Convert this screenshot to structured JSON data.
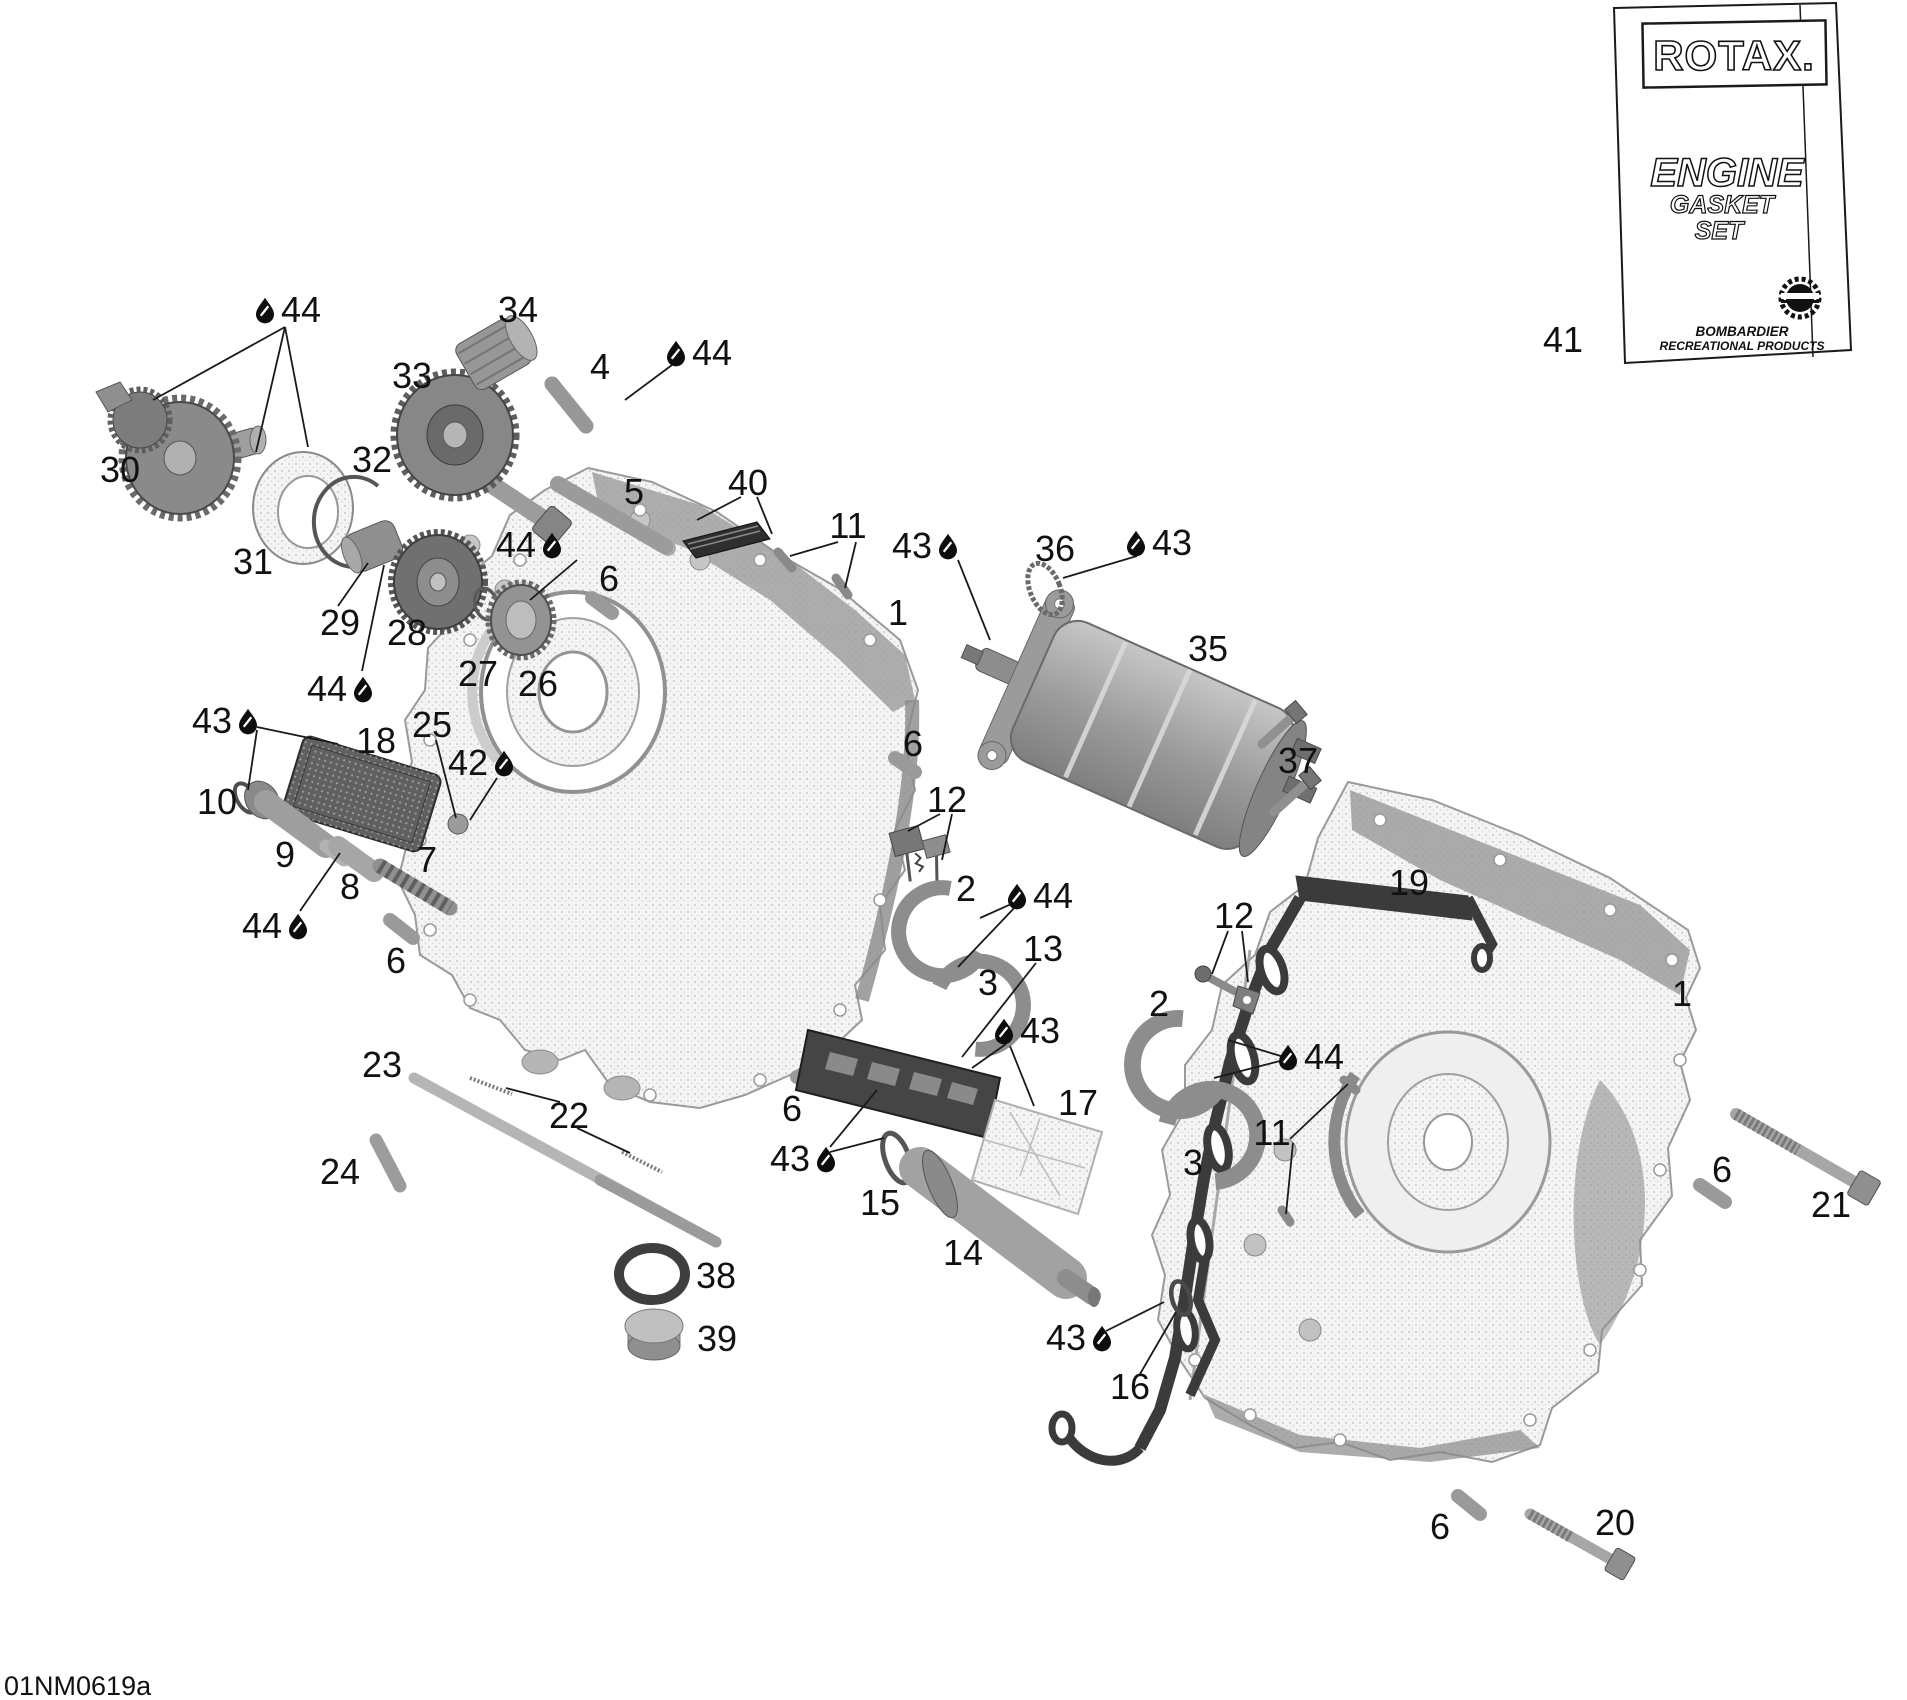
{
  "page": {
    "background": "#ffffff",
    "diagram_code": "01NM0619a"
  },
  "colors": {
    "ink": "#1a1a1a",
    "part_gray": "#9a9a9a",
    "dark_plate": "#454545",
    "gasket_dark": "#3b3b3b",
    "stipple_light": "#c9c9c9",
    "oil_drop": "#0d0d0d"
  },
  "gasket_kit": {
    "callout": "41",
    "brand": "ROTAX.",
    "product_line1": "ENGINE",
    "product_line2": "GASKET",
    "product_line3": "SET",
    "manufacturer_line1": "BOMBARDIER",
    "manufacturer_line2": "RECREATIONAL PRODUCTS",
    "logo": "gear-emblem-icon"
  },
  "legend": {
    "oil_drop_icon": "oil-drop-icon"
  },
  "callouts": [
    {
      "label": "44",
      "x": 301,
      "y": 309,
      "drop": "left"
    },
    {
      "label": "34",
      "x": 518,
      "y": 309,
      "drop": "none"
    },
    {
      "label": "4",
      "x": 600,
      "y": 366,
      "drop": "none"
    },
    {
      "label": "44",
      "x": 712,
      "y": 352,
      "drop": "left"
    },
    {
      "label": "33",
      "x": 412,
      "y": 375,
      "drop": "none"
    },
    {
      "label": "30",
      "x": 120,
      "y": 469,
      "drop": "none"
    },
    {
      "label": "32",
      "x": 372,
      "y": 459,
      "drop": "none"
    },
    {
      "label": "31",
      "x": 253,
      "y": 561,
      "drop": "none"
    },
    {
      "label": "5",
      "x": 634,
      "y": 491,
      "drop": "none"
    },
    {
      "label": "40",
      "x": 748,
      "y": 482,
      "drop": "none"
    },
    {
      "label": "44",
      "x": 516,
      "y": 544,
      "drop": "right"
    },
    {
      "label": "6",
      "x": 609,
      "y": 578,
      "drop": "none"
    },
    {
      "label": "11",
      "x": 848,
      "y": 525,
      "drop": "none"
    },
    {
      "label": "43",
      "x": 912,
      "y": 545,
      "drop": "right"
    },
    {
      "label": "36",
      "x": 1055,
      "y": 548,
      "drop": "none"
    },
    {
      "label": "43",
      "x": 1172,
      "y": 542,
      "drop": "left"
    },
    {
      "label": "1",
      "x": 898,
      "y": 612,
      "drop": "none"
    },
    {
      "label": "35",
      "x": 1208,
      "y": 648,
      "drop": "none"
    },
    {
      "label": "29",
      "x": 340,
      "y": 622,
      "drop": "none"
    },
    {
      "label": "28",
      "x": 407,
      "y": 632,
      "drop": "none"
    },
    {
      "label": "27",
      "x": 478,
      "y": 673,
      "drop": "none"
    },
    {
      "label": "26",
      "x": 538,
      "y": 683,
      "drop": "none"
    },
    {
      "label": "44",
      "x": 327,
      "y": 688,
      "drop": "right"
    },
    {
      "label": "43",
      "x": 212,
      "y": 720,
      "drop": "right"
    },
    {
      "label": "18",
      "x": 376,
      "y": 740,
      "drop": "none"
    },
    {
      "label": "25",
      "x": 432,
      "y": 724,
      "drop": "none"
    },
    {
      "label": "42",
      "x": 468,
      "y": 762,
      "drop": "right"
    },
    {
      "label": "10",
      "x": 217,
      "y": 801,
      "drop": "none"
    },
    {
      "label": "9",
      "x": 285,
      "y": 854,
      "drop": "none"
    },
    {
      "label": "8",
      "x": 350,
      "y": 886,
      "drop": "none"
    },
    {
      "label": "7",
      "x": 427,
      "y": 859,
      "drop": "none"
    },
    {
      "label": "44",
      "x": 262,
      "y": 925,
      "drop": "right"
    },
    {
      "label": "6",
      "x": 396,
      "y": 960,
      "drop": "none"
    },
    {
      "label": "12",
      "x": 947,
      "y": 799,
      "drop": "none"
    },
    {
      "label": "6",
      "x": 913,
      "y": 743,
      "drop": "none"
    },
    {
      "label": "2",
      "x": 966,
      "y": 888,
      "drop": "none"
    },
    {
      "label": "44",
      "x": 1053,
      "y": 895,
      "drop": "left"
    },
    {
      "label": "13",
      "x": 1043,
      "y": 948,
      "drop": "none"
    },
    {
      "label": "3",
      "x": 988,
      "y": 982,
      "drop": "none"
    },
    {
      "label": "43",
      "x": 1040,
      "y": 1030,
      "drop": "left"
    },
    {
      "label": "17",
      "x": 1078,
      "y": 1102,
      "drop": "none"
    },
    {
      "label": "2",
      "x": 1159,
      "y": 1003,
      "drop": "none"
    },
    {
      "label": "12",
      "x": 1234,
      "y": 915,
      "drop": "none"
    },
    {
      "label": "19",
      "x": 1409,
      "y": 882,
      "drop": "none"
    },
    {
      "label": "44",
      "x": 1324,
      "y": 1056,
      "drop": "left"
    },
    {
      "label": "11",
      "x": 1272,
      "y": 1132,
      "drop": "none"
    },
    {
      "label": "3",
      "x": 1193,
      "y": 1162,
      "drop": "none"
    },
    {
      "label": "37",
      "x": 1298,
      "y": 760,
      "drop": "none"
    },
    {
      "label": "1",
      "x": 1682,
      "y": 993,
      "drop": "none"
    },
    {
      "label": "6",
      "x": 1722,
      "y": 1169,
      "drop": "none"
    },
    {
      "label": "21",
      "x": 1831,
      "y": 1204,
      "drop": "none"
    },
    {
      "label": "23",
      "x": 382,
      "y": 1064,
      "drop": "none"
    },
    {
      "label": "22",
      "x": 569,
      "y": 1115,
      "drop": "none"
    },
    {
      "label": "24",
      "x": 340,
      "y": 1171,
      "drop": "none"
    },
    {
      "label": "38",
      "x": 716,
      "y": 1275,
      "drop": "none"
    },
    {
      "label": "39",
      "x": 717,
      "y": 1338,
      "drop": "none"
    },
    {
      "label": "6",
      "x": 792,
      "y": 1108,
      "drop": "none"
    },
    {
      "label": "43",
      "x": 790,
      "y": 1158,
      "drop": "right"
    },
    {
      "label": "15",
      "x": 880,
      "y": 1202,
      "drop": "none"
    },
    {
      "label": "14",
      "x": 963,
      "y": 1252,
      "drop": "none"
    },
    {
      "label": "43",
      "x": 1066,
      "y": 1337,
      "drop": "right"
    },
    {
      "label": "16",
      "x": 1130,
      "y": 1386,
      "drop": "none"
    },
    {
      "label": "6",
      "x": 1440,
      "y": 1526,
      "drop": "none"
    },
    {
      "label": "20",
      "x": 1615,
      "y": 1522,
      "drop": "none"
    },
    {
      "label": "41",
      "x": 1563,
      "y": 339,
      "drop": "none"
    }
  ]
}
